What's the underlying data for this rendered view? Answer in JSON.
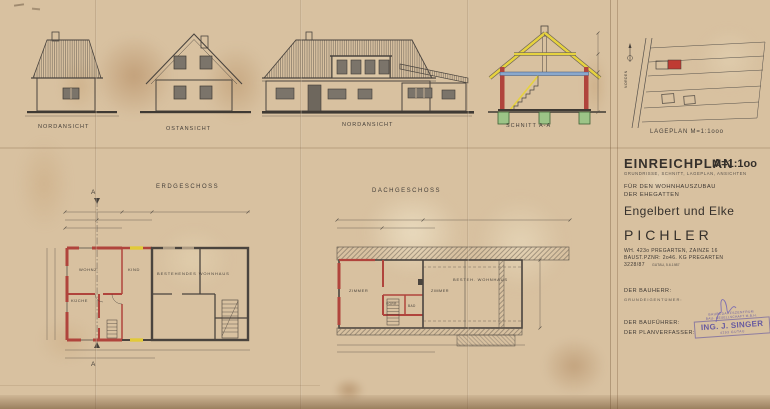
{
  "colors": {
    "ink": "#46403a",
    "new_wall_red": "#b0443c",
    "demolition_yellow": "#e2ca38",
    "foundation_green": "#9cc487",
    "slab_blue": "#8aa8cc",
    "stamp_purple": "#5b4fa0",
    "paper": "#d8c1a0"
  },
  "views": {
    "elevation_small_1": {
      "label": "NORDANSICHT"
    },
    "elevation_small_2": {
      "label": "OSTANSICHT"
    },
    "elevation_main": {
      "label": "NORDANSICHT"
    },
    "section": {
      "label": "SCHNITT A-A"
    },
    "siteplan": {
      "label": "LAGEPLAN M=1:1ooo",
      "north_label": "NORDEN"
    }
  },
  "floorplans": {
    "erdgeschoss": {
      "title": "ERDGESCHOSS",
      "section_marker": "A",
      "rooms": {
        "wohnzimmer": "WOHNZ.",
        "kueche": "KÜCHE",
        "kind": "KIND",
        "bestand": "BESTEHENDES WOHNHAUS"
      }
    },
    "dachgeschoss": {
      "title": "DACHGESCHOSS",
      "rooms": {
        "zimmer1": "ZIMMER",
        "zimmer2": "ZIMMER",
        "vorraum": "VORR.",
        "bad": "BAD",
        "bestand": "BESTEH. WOHNHAUS"
      }
    }
  },
  "titleblock": {
    "title": "EINREICHPLAN",
    "scale": "M=1:1oo",
    "subtitle": "GRUNDRISSE, SCHNITT, LAGEPLAN, ANSICHTEN",
    "purpose_line1": "FÜR DEN WOHNHAUSZUBAU",
    "purpose_line2": "DER EHEGATTEN",
    "owner_first_names": "Engelbert und Elke",
    "owner_surname": "PICHLER",
    "address_line1": "WH. 423o PREGARTEN, ZAINZE 16",
    "address_line2": "BAUST.PZNR: 2o46. KG PREGARTEN",
    "plan_number": "3228/87",
    "date_note": "GUTAU, 5.6.1987",
    "role_bauherr": "DER BAUHERR:",
    "role_grundeigentuemer": "GRUNDEIGENTÜMER:",
    "role_baufuehrer": "DER BAUFÜHRER:",
    "role_planverfasser": "DER PLANVERFASSER:",
    "stamp": {
      "line1": "BAUBEDARFSZENTRUM",
      "line2": "BAU- GESELLSCHAFT M.B.H.",
      "line3": "ING. J. SINGER",
      "line4": "4293 GUTAU"
    }
  }
}
